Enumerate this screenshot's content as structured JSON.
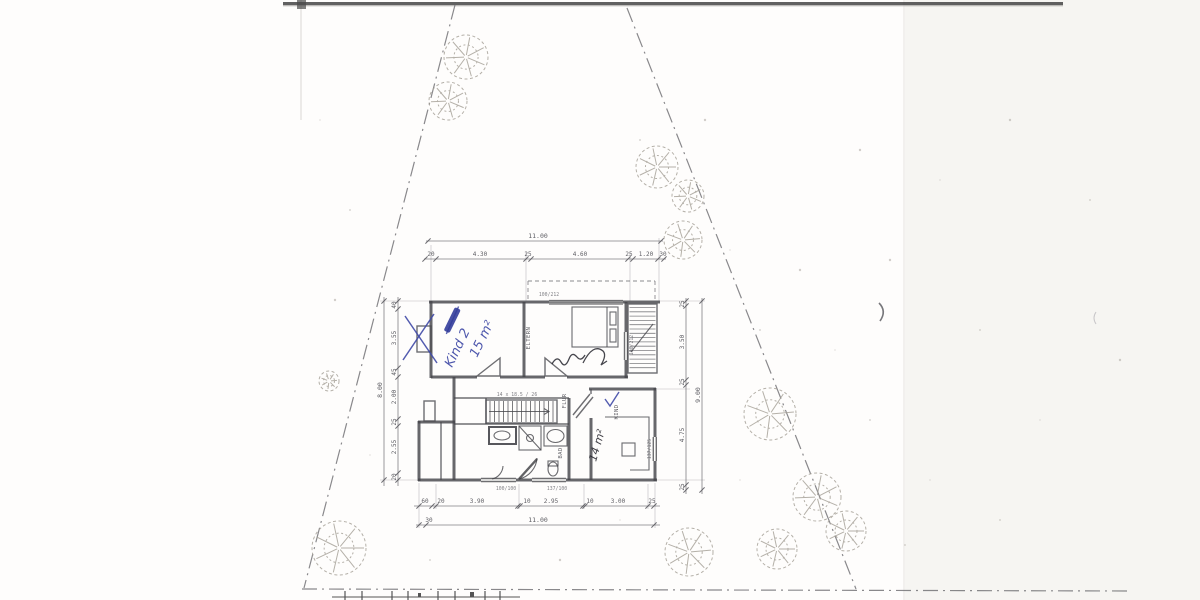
{
  "drawing": {
    "dimensions_top": {
      "total": "11.00",
      "chain": [
        "20",
        "4.30",
        "25",
        "4.60",
        "25",
        "1.20",
        "30"
      ]
    },
    "dimensions_bottom": {
      "total": "11.00",
      "left_offset": "30",
      "chain": [
        "60",
        "20",
        "3.90",
        "10",
        "2.95",
        "10",
        "3.00",
        "25"
      ]
    },
    "dimensions_left": {
      "total": "8.00",
      "chain": [
        "40",
        "3.55",
        "45",
        "2.00",
        "25",
        "2.55",
        "20"
      ]
    },
    "dimensions_right": {
      "total": "9.00",
      "chain": [
        "25",
        "3.50",
        "25",
        "4.75",
        "25"
      ]
    },
    "room_labels": {
      "eltern": "ELTERN",
      "flur": "FLUR",
      "bad": "BAD",
      "kind": "KIND"
    },
    "stair_note": "14 x 18.5 / 26",
    "window_labels": {
      "top": "100/212",
      "balcony": "100/212",
      "bottom_left": "100/100",
      "bottom_right": "137/100",
      "right": "137/125"
    },
    "handwritten": {
      "room1_name": "Kind 2",
      "room1_area": "15 m²",
      "room2_area": "14 m²",
      "ink_blue": "#3f49a6",
      "ink_dark": "#26262e"
    }
  }
}
